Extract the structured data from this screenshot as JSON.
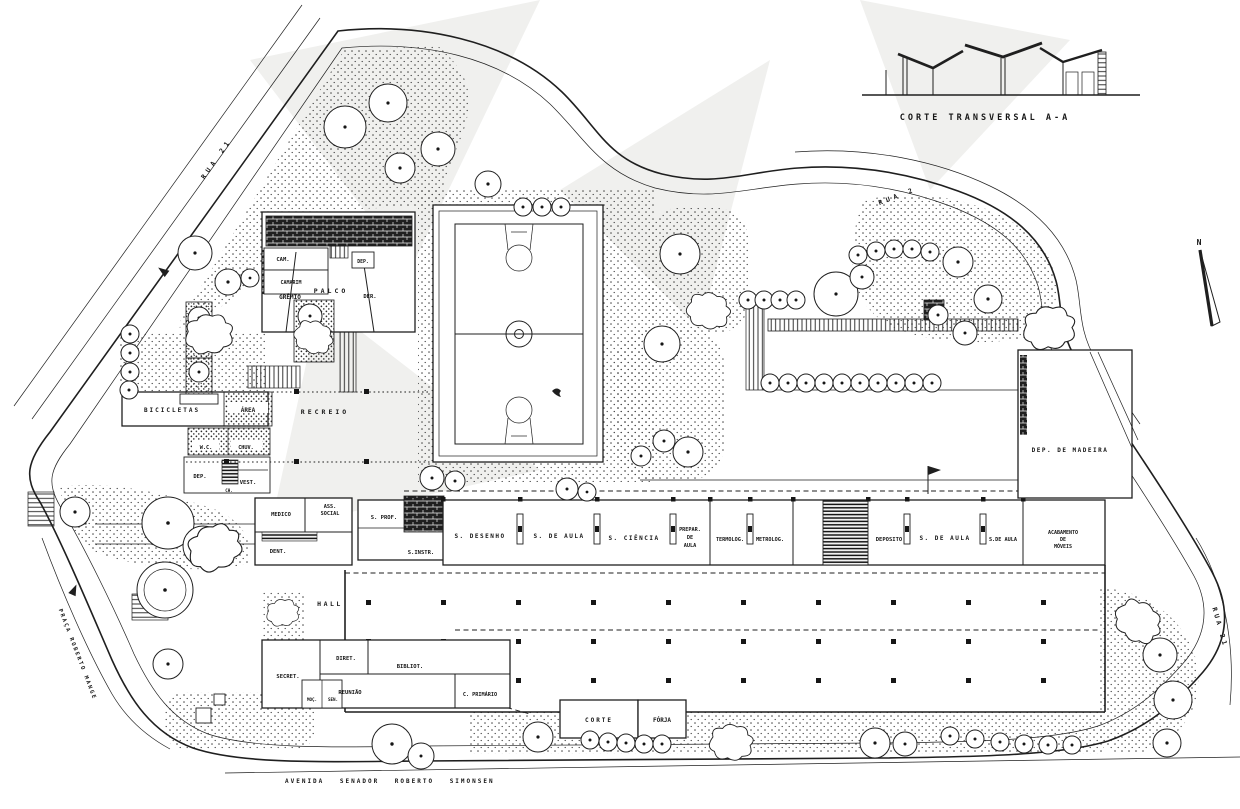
{
  "palette": {
    "ink": "#1f1f1f",
    "paper": "#ffffff",
    "stipple": "#333333"
  },
  "section": {
    "caption": "CORTE TRANSVERSAL A-A"
  },
  "compass": {
    "north": "N"
  },
  "streets": {
    "top_left": "RUA 21",
    "top_right": "RUA 2",
    "right_edge": "RUA 21",
    "praca": "PRAÇA ROBERTO MANGE",
    "avenida": "AVENIDA SENADOR ROBERTO SIMONSEN"
  },
  "rooms": {
    "gremio": "GRÊMIO",
    "cam": "CAM.",
    "camarim": "CAMARIM",
    "palco": "PALCO",
    "dep_palco": "DEP.",
    "der": "DER.",
    "bicicletas": "BICICLETAS",
    "area": "ÁREA",
    "recreio": "RECREIO",
    "wc": "W.C.",
    "chuv": "CHUV.",
    "dep": "DEP.",
    "vest": "VEST.",
    "ch": "CH.",
    "medico": "MEDICO",
    "ass_l1": "ASS.",
    "ass_l2": "SOCIAL",
    "dent": "DENT.",
    "s_prof": "S. PROF.",
    "s_instr": "S.INSTR.",
    "s_desenho": "S. DESENHO",
    "s_de_aula_1": "S. DE AULA",
    "s_ciencia": "S. CIÊNCIA",
    "prepar_l1": "PREPAR.",
    "prepar_l2": "DE",
    "prepar_l3": "AULA",
    "termolog": "TERMOLOG.",
    "metrolog": "METROLOG.",
    "deposito": "DEPOSITO",
    "s_de_aula_2": "S. DE AULA",
    "s_de_aula_3": "S.DE AULA",
    "acab_l1": "ACABAMENTO",
    "acab_l2": "DE",
    "acab_l3": "MÓVEIS",
    "dep_madeira": "DEP. DE MADEIRA",
    "hall": "HALL",
    "secret": "SECRET.",
    "diret": "DIRET.",
    "bibliot": "BIBLIOT.",
    "reuniao": "REUNIÃO",
    "c_primario": "C. PRIMÁRIO",
    "moc": "MOÇ.",
    "sen": "SEN.",
    "corte": "CORTE",
    "forja": "FÓRJA"
  }
}
